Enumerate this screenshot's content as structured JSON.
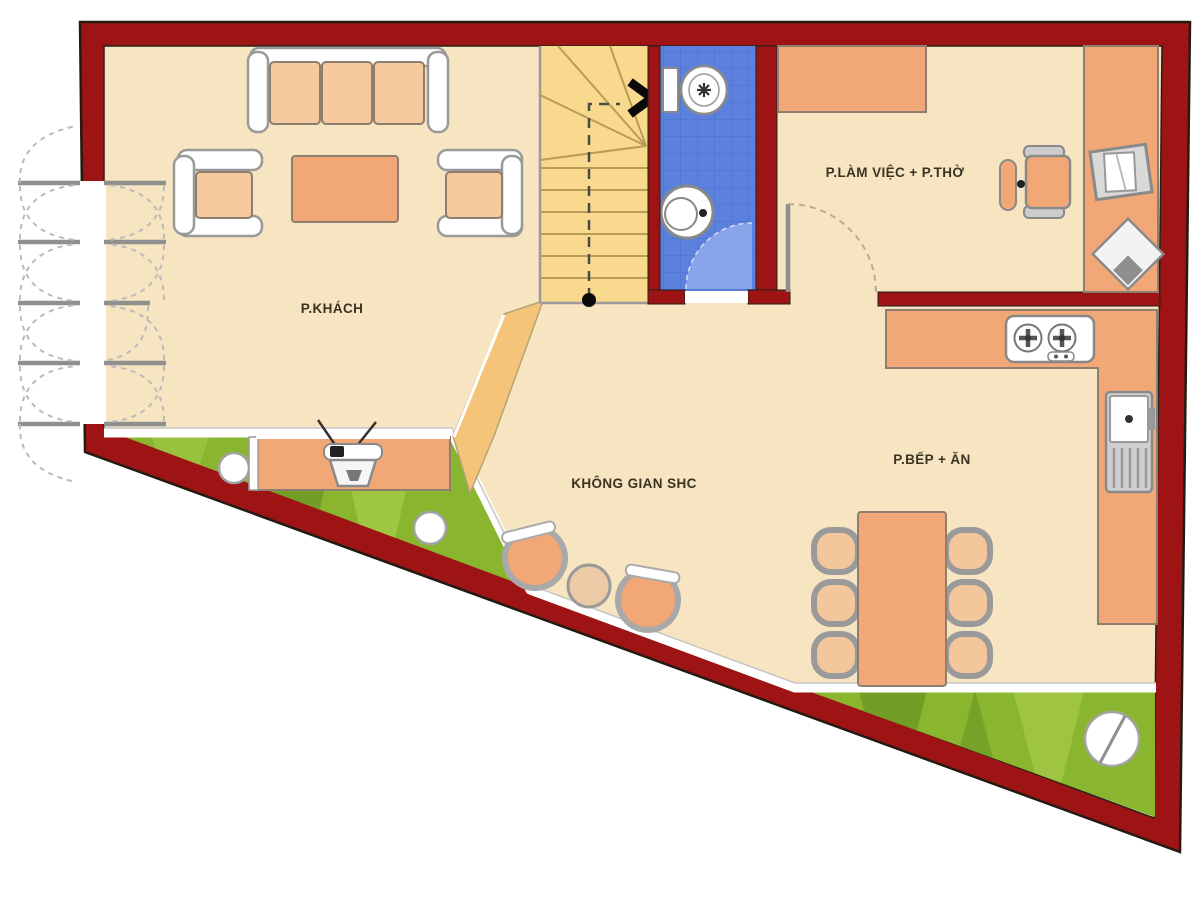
{
  "page": {
    "type": "architectural-floor-plan",
    "background": "#ffffff"
  },
  "rooms": {
    "living": {
      "label": "P.KHÁCH"
    },
    "common": {
      "label": "KHÔNG GIAN SHC"
    },
    "work_worship": {
      "label": "P.LÀM VIỆC + P.THỜ"
    },
    "kitchen_dining": {
      "label": "P.BẾP + ĂN"
    }
  },
  "depicted_objects": [
    "sofa",
    "armchair",
    "coffee-table",
    "tv-cabinet",
    "tv",
    "staircase",
    "stair-direction-arrow",
    "toilet",
    "wash-basin",
    "office-chair",
    "desk-counter",
    "monitor",
    "printer",
    "kitchen-counter",
    "stove",
    "sink-unit",
    "dining-table",
    "dining-chair",
    "tub-chair",
    "side-table",
    "folding-entrance-doors",
    "garden-strip",
    "stepping-stone"
  ],
  "colors": {
    "wall": "#9e1414",
    "floor": "#f7e4c1",
    "stairs": "#f9d98d",
    "bathroom_tile": "#5b81dd",
    "door_swing": "#8aa4e9",
    "furniture_orange": "#f2a876",
    "cushion": "#f6c89e",
    "grass": "#8ab52f",
    "label_text": "#3a3322"
  }
}
